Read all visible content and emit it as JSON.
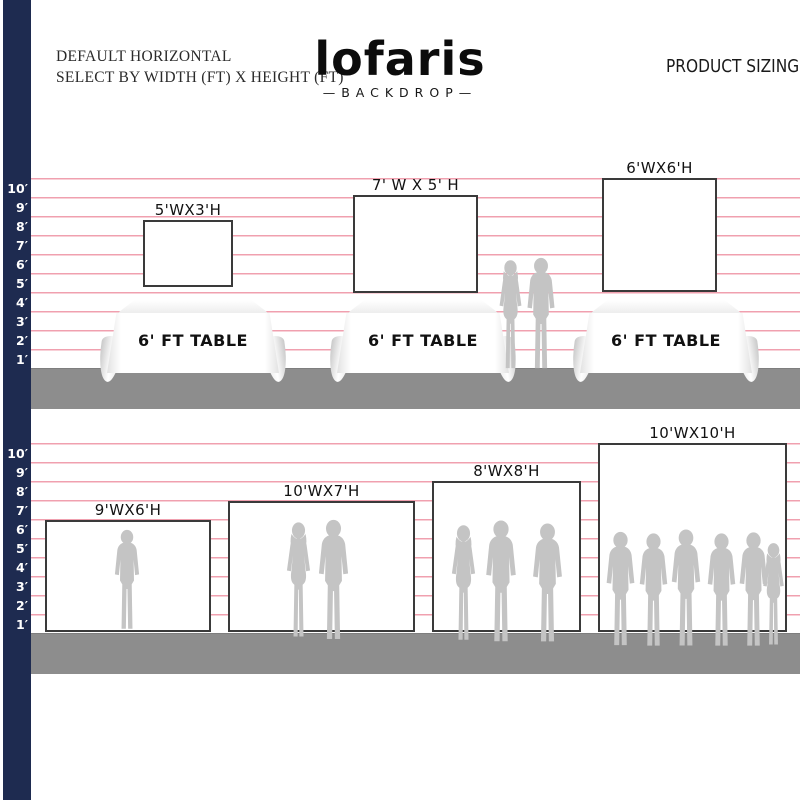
{
  "header": {
    "title_line1": "DEFAULT HORIZONTAL",
    "title_line2": "SELECT BY WIDTH (FT) X HEIGHT (FT)",
    "brand_name": "lofaris",
    "brand_subtitle": "—BACKDROP—",
    "product_sizing": "PRODUCT SIZING"
  },
  "ruler": {
    "labels": [
      "10′",
      "9′",
      "8′",
      "7′",
      "6′",
      "5′",
      "4′",
      "3′",
      "2′",
      "1′"
    ]
  },
  "top_section": {
    "backdrops": [
      {
        "label": "5'WX3'H"
      },
      {
        "label": "7' W X 5' H"
      },
      {
        "label": "6'WX6'H"
      }
    ],
    "tables": [
      {
        "label": "6' FT TABLE"
      },
      {
        "label": "6' FT TABLE"
      },
      {
        "label": "6' FT TABLE"
      }
    ]
  },
  "bottom_section": {
    "backdrops": [
      {
        "label": "9'WX6'H"
      },
      {
        "label": "10'WX7'H"
      },
      {
        "label": "8'WX8'H"
      },
      {
        "label": "10'WX10'H"
      }
    ]
  },
  "colors": {
    "navy_bar": "#1e2b50",
    "grid_line_pink": "#f0a0af",
    "ground_gray": "#8d8d8d",
    "silhouette_gray": "#c4c4c4",
    "backdrop_border": "#3a3a3a"
  }
}
